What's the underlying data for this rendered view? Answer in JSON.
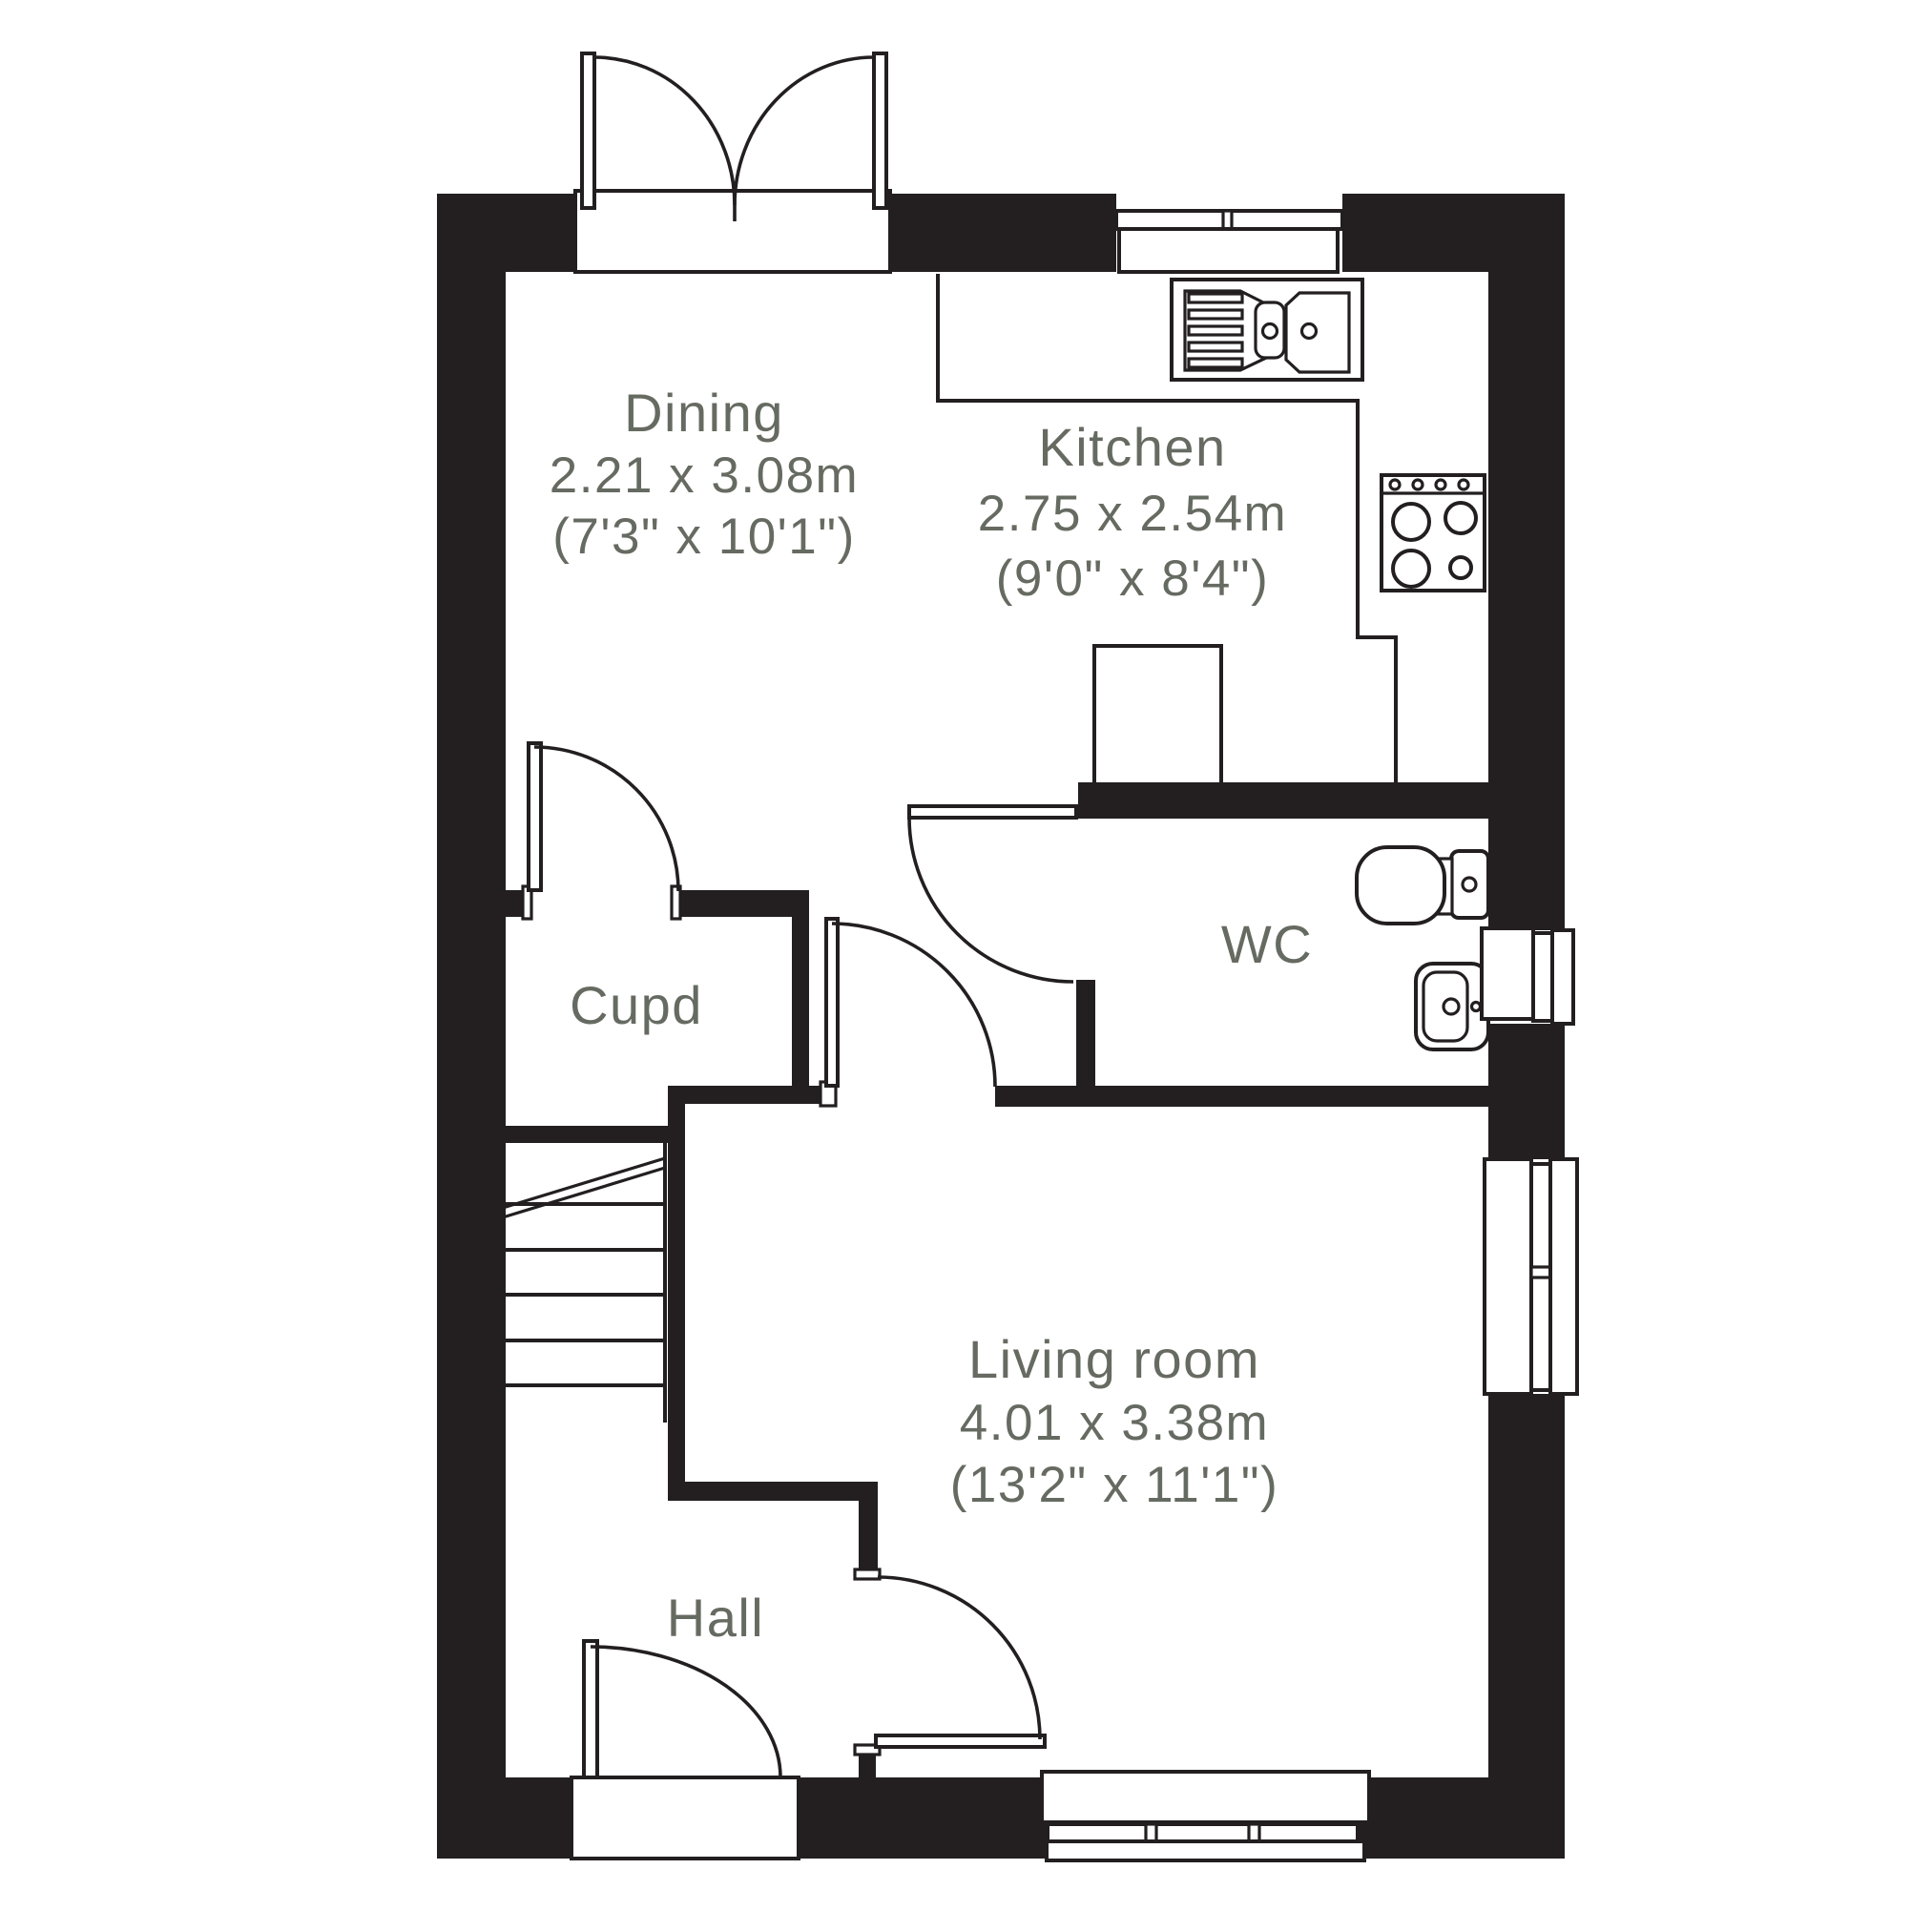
{
  "plan": {
    "type": "floor-plan",
    "colors": {
      "wall": "#231f20",
      "line": "#231f20",
      "label": "#666b62",
      "background": "#ffffff"
    },
    "rooms": {
      "dining": {
        "name": "Dining",
        "metric": "2.21 x 3.08m",
        "imperial": "(7'3\" x 10'1\")"
      },
      "kitchen": {
        "name": "Kitchen",
        "metric": "2.75 x 2.54m",
        "imperial": "(9'0\" x 8'4\")"
      },
      "wc": {
        "name": "WC"
      },
      "cupboard": {
        "name": "Cupd"
      },
      "hall": {
        "name": "Hall"
      },
      "living": {
        "name": "Living room",
        "metric": "4.01 x 3.38m",
        "imperial": "(13'2\" x 11'1\")"
      }
    },
    "fixtures": [
      "french-doors",
      "kitchen-window",
      "kitchen-sink",
      "kitchen-worktop-edge",
      "hob",
      "appliance-unit",
      "wc-door",
      "toilet",
      "wash-basin",
      "wc-window",
      "staircase",
      "cupboard-door",
      "living-room-nook-door",
      "hall-living-door",
      "living-room-side-window",
      "living-room-rear-window",
      "front-door"
    ]
  }
}
